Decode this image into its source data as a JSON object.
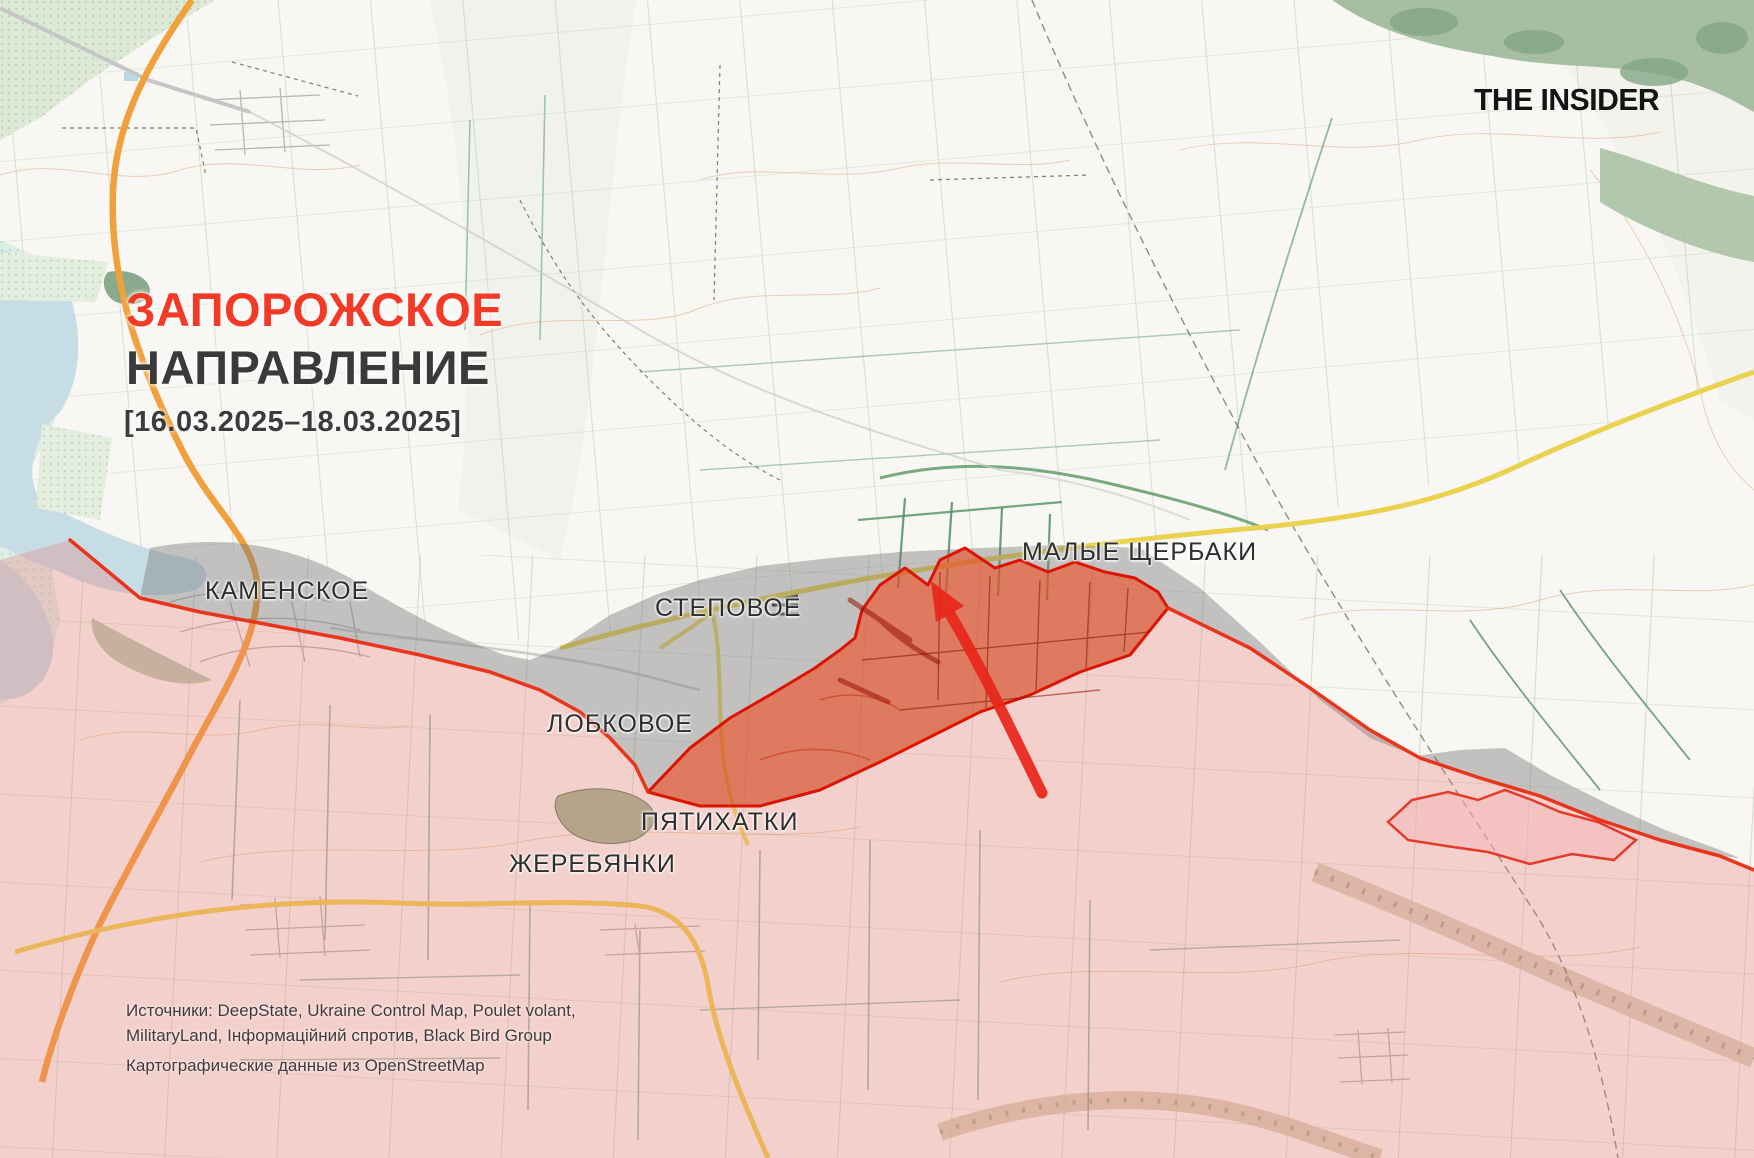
{
  "brand": {
    "logo": "THE INSIDER"
  },
  "header": {
    "title_accent": "ЗАПОРОЖСКОЕ",
    "title_rest": "НАПРАВЛЕНИЕ",
    "date_range": "[16.03.2025–18.03.2025]"
  },
  "map": {
    "labels": [
      {
        "id": "kamenskoe",
        "text": "КАМЕНСКОЕ"
      },
      {
        "id": "stepovoe",
        "text": "СТЕПОВОЕ"
      },
      {
        "id": "malye-shcherbaki",
        "text": "МАЛЫЕ ЩЕРБАКИ"
      },
      {
        "id": "lobkovoe",
        "text": "ЛОБКОВОЕ"
      },
      {
        "id": "pyatikhatki",
        "text": "ПЯТИХАТКИ"
      },
      {
        "id": "zherebyanki",
        "text": "ЖЕРЕБЯНКИ"
      }
    ],
    "zones": {
      "occupied": "russian-occupied-area",
      "contested": "gray-contested-area",
      "advance": "recent-advance-area",
      "arrow": "attack-direction-arrow"
    }
  },
  "sources": {
    "line1": "Источники: DeepState, Ukraine Control Map, Poulet volant,",
    "line2": "MilitaryLand, Інформаційний спротив, Black Bird Group",
    "line3": "Картографические данные из OpenStreetMap"
  },
  "colors": {
    "title_accent": "#f23a26",
    "front_line": "#e92c12",
    "advance_border": "#dc1404",
    "advance_fill": "#f3461a",
    "occupied_pink": "#f4cecb",
    "contested_gray": "#c5c5c5",
    "water": "#c6dde6",
    "road_yellow": "#ead24f",
    "road_orange": "#f0a13c",
    "field_green": "#4d9160",
    "forest_green": "#a6bfa0"
  }
}
